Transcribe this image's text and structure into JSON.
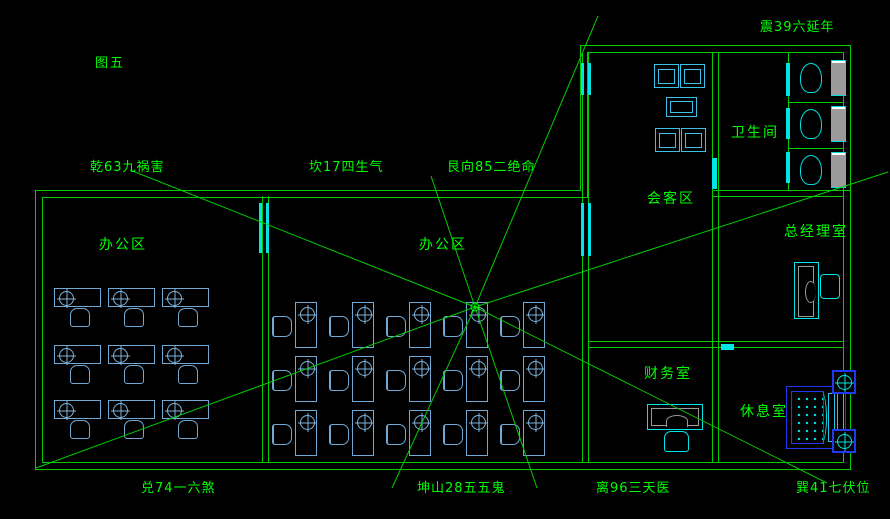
{
  "figure_label": {
    "text": "图五",
    "x": 95,
    "y": 57
  },
  "colors": {
    "background": "#000000",
    "wall_green": "#00cc00",
    "label_green": "#00ff00",
    "desk_blue": "#72a8d4",
    "fixture_cyan": "#00e5e5",
    "bed_blue": "#2238f0",
    "tank_gray": "#9a9a9a"
  },
  "compass_labels": [
    {
      "id": "zhen",
      "text": "震39六延年",
      "x": 760,
      "y": 21
    },
    {
      "id": "qian",
      "text": "乾63九祸害",
      "x": 90,
      "y": 161
    },
    {
      "id": "kan",
      "text": "坎17四生气",
      "x": 309,
      "y": 161
    },
    {
      "id": "gen",
      "text": "艮向85二绝命",
      "x": 447,
      "y": 161
    },
    {
      "id": "dui",
      "text": "兑74一六煞",
      "x": 141,
      "y": 482
    },
    {
      "id": "kun",
      "text": "坤山28五五鬼",
      "x": 417,
      "y": 482
    },
    {
      "id": "li",
      "text": "离96三天医",
      "x": 596,
      "y": 482
    },
    {
      "id": "xun",
      "text": "巽41七伏位",
      "x": 796,
      "y": 482
    }
  ],
  "room_labels": [
    {
      "id": "office-left",
      "text": "办公区",
      "x": 99,
      "y": 238
    },
    {
      "id": "office-center",
      "text": "办公区",
      "x": 419,
      "y": 238
    },
    {
      "id": "reception",
      "text": "会客区",
      "x": 647,
      "y": 192
    },
    {
      "id": "bathroom",
      "text": "卫生间",
      "x": 731,
      "y": 126
    },
    {
      "id": "gm-office",
      "text": "总经理室",
      "x": 784,
      "y": 225
    },
    {
      "id": "finance",
      "text": "财务室",
      "x": 644,
      "y": 367
    },
    {
      "id": "rest-room",
      "text": "休息室",
      "x": 740,
      "y": 405
    }
  ],
  "rays": {
    "cx": 475,
    "cy": 307,
    "ends": [
      [
        130,
        170
      ],
      [
        431,
        176
      ],
      [
        598,
        16
      ],
      [
        888,
        172
      ],
      [
        36,
        468
      ],
      [
        392,
        488
      ],
      [
        537,
        488
      ],
      [
        827,
        483
      ]
    ]
  },
  "desk_grids": [
    {
      "id": "office-left",
      "cols": [
        54,
        108,
        162
      ],
      "rows": [
        288,
        345,
        400
      ],
      "dw": 47,
      "dh": 19,
      "chair": "below"
    },
    {
      "id": "office-center",
      "cols": [
        295,
        352,
        409,
        466,
        523
      ],
      "rows": [
        302,
        356,
        410
      ],
      "dw": 22,
      "dh": 46,
      "chair": "left"
    }
  ],
  "reception_furniture": {
    "chairs": [
      [
        654,
        64
      ],
      [
        680,
        64
      ],
      [
        655,
        128
      ],
      [
        681,
        128
      ]
    ],
    "chair_w": 25,
    "chair_h": 24,
    "table": [
      666,
      97,
      31,
      20
    ]
  },
  "gm_furniture": {
    "desk": [
      794,
      262,
      25,
      57
    ],
    "chair": [
      820,
      274,
      20,
      25
    ]
  },
  "finance_furniture": {
    "desk": [
      647,
      404,
      56,
      26
    ],
    "chair": [
      664,
      431,
      25,
      21
    ]
  },
  "toilets": [
    [
      800,
      60
    ],
    [
      800,
      106
    ],
    [
      800,
      152
    ]
  ],
  "bed": {
    "frame": [
      786,
      386,
      60,
      63
    ],
    "mattress": [
      791,
      391,
      33,
      53
    ],
    "pillows": [
      [
        828,
        393,
        7,
        49
      ],
      [
        837,
        393,
        7,
        49
      ]
    ],
    "arc": [
      815,
      391,
      12,
      53
    ]
  },
  "wall_fixtures": [
    [
      832,
      370
    ],
    [
      832,
      429
    ]
  ],
  "windows": [
    [
      259,
      203,
      3,
      50
    ],
    [
      266,
      203,
      3,
      50
    ],
    [
      581,
      203,
      3,
      53
    ],
    [
      588,
      203,
      3,
      53
    ],
    [
      581,
      63,
      3,
      32
    ],
    [
      588,
      63,
      3,
      32
    ],
    [
      712,
      158,
      5,
      31
    ],
    [
      786,
      63,
      4,
      33
    ],
    [
      786,
      108,
      4,
      31
    ],
    [
      786,
      152,
      4,
      31
    ],
    [
      721,
      344,
      13,
      6
    ]
  ]
}
